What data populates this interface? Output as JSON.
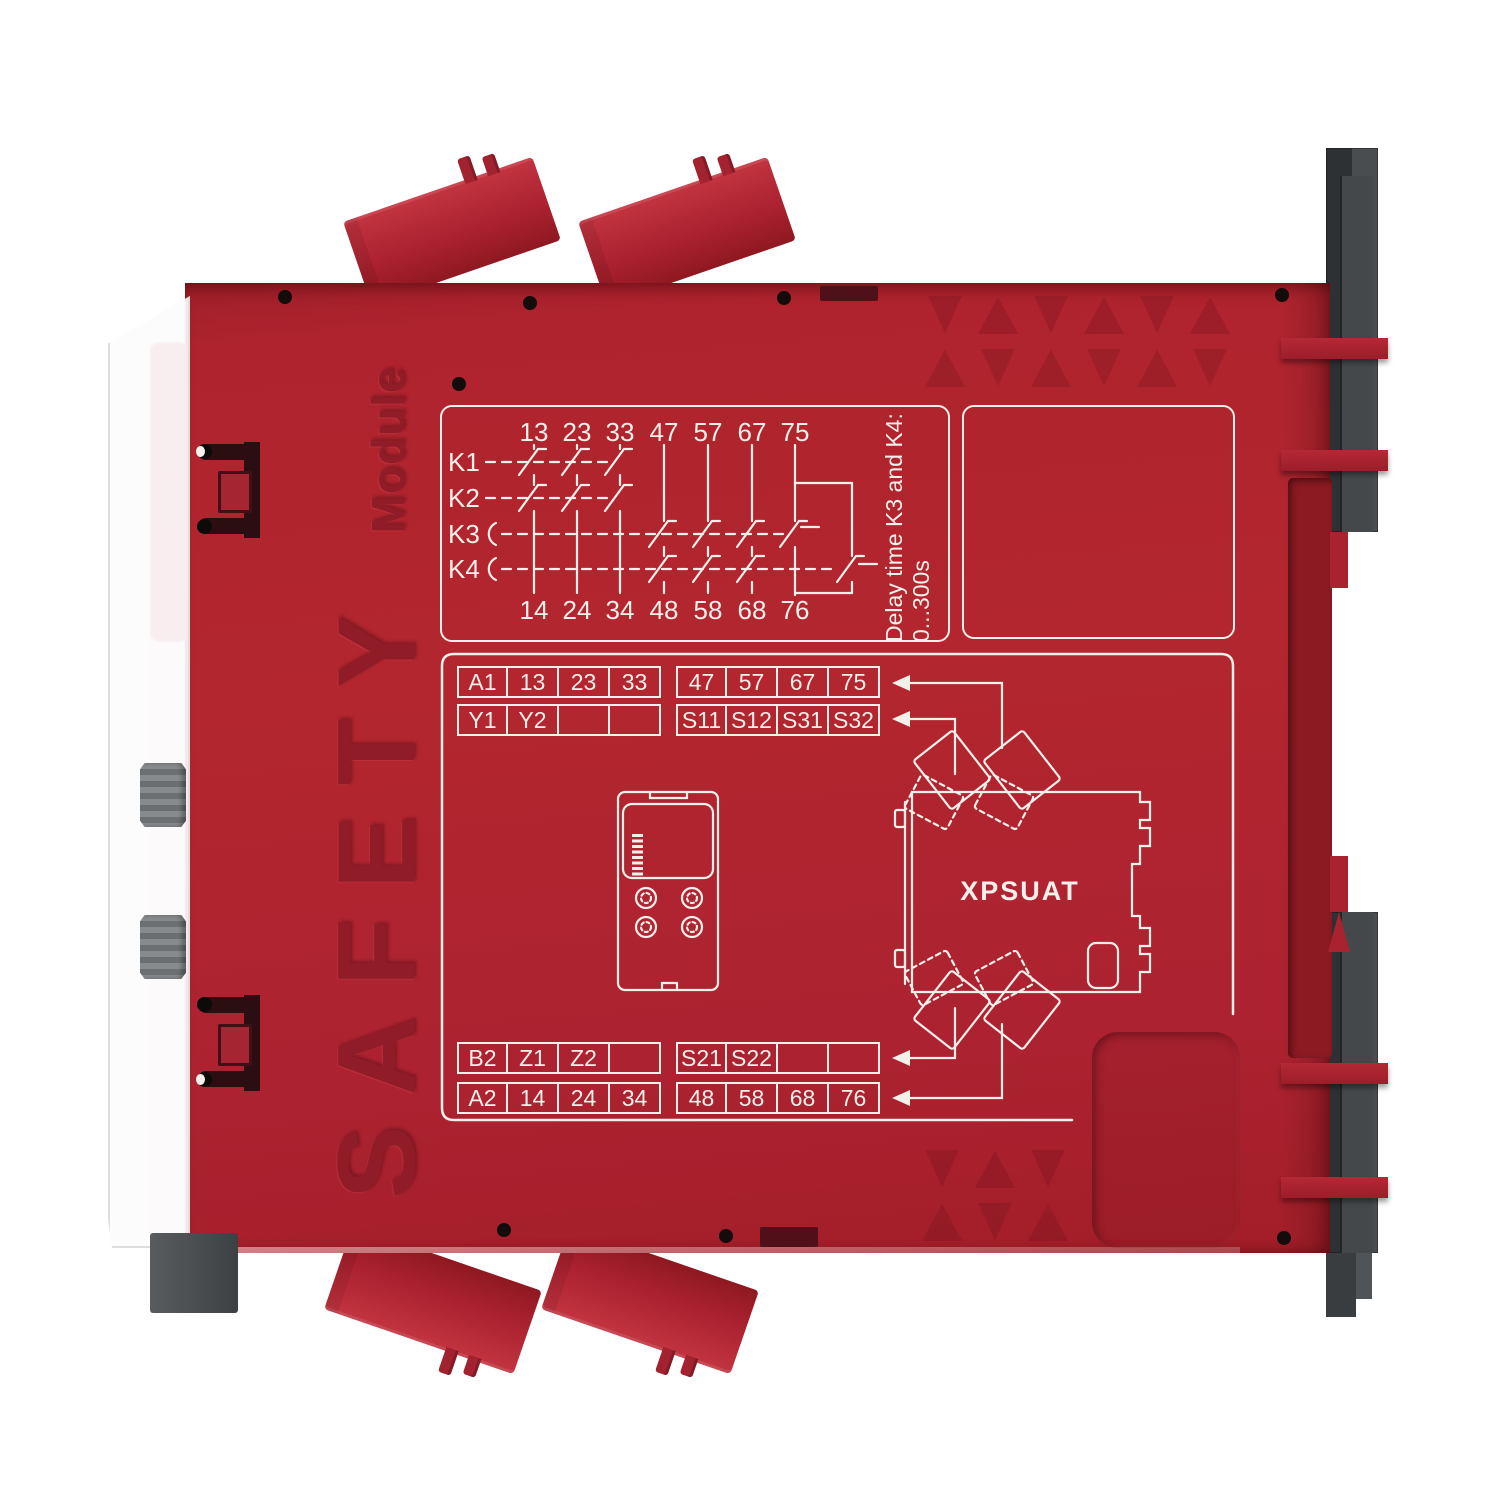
{
  "product": {
    "embossed_title": "SAFETY",
    "embossed_subtitle": "Module",
    "model_label": "XPSUAT"
  },
  "schematic": {
    "relays": [
      "K1",
      "K2",
      "K3",
      "K4"
    ],
    "top_terminals": [
      "13",
      "23",
      "33",
      "47",
      "57",
      "67",
      "75"
    ],
    "bottom_terminals": [
      "14",
      "24",
      "34",
      "48",
      "58",
      "68",
      "76"
    ],
    "delay_note": [
      "Delay time K3 and K4:",
      "0...300s"
    ]
  },
  "terminal_tables": {
    "top_left": [
      [
        "A1",
        "13",
        "23",
        "33"
      ],
      [
        "Y1",
        "Y2",
        "",
        ""
      ]
    ],
    "top_right": [
      [
        "47",
        "57",
        "67",
        "75"
      ],
      [
        "S11",
        "S12",
        "S31",
        "S32"
      ]
    ],
    "bottom_left": [
      [
        "B2",
        "Z1",
        "Z2",
        ""
      ],
      [
        "A2",
        "14",
        "24",
        "34"
      ]
    ],
    "bottom_right": [
      [
        "S21",
        "S22",
        "",
        ""
      ],
      [
        "48",
        "58",
        "68",
        "76"
      ]
    ]
  },
  "colors": {
    "housing_red": "#ad2430",
    "embossed_red": "#8f1b24",
    "print_white": "#f3efe9",
    "clip_gray": "#3c3f42",
    "knob_gray": "#7d8083"
  }
}
